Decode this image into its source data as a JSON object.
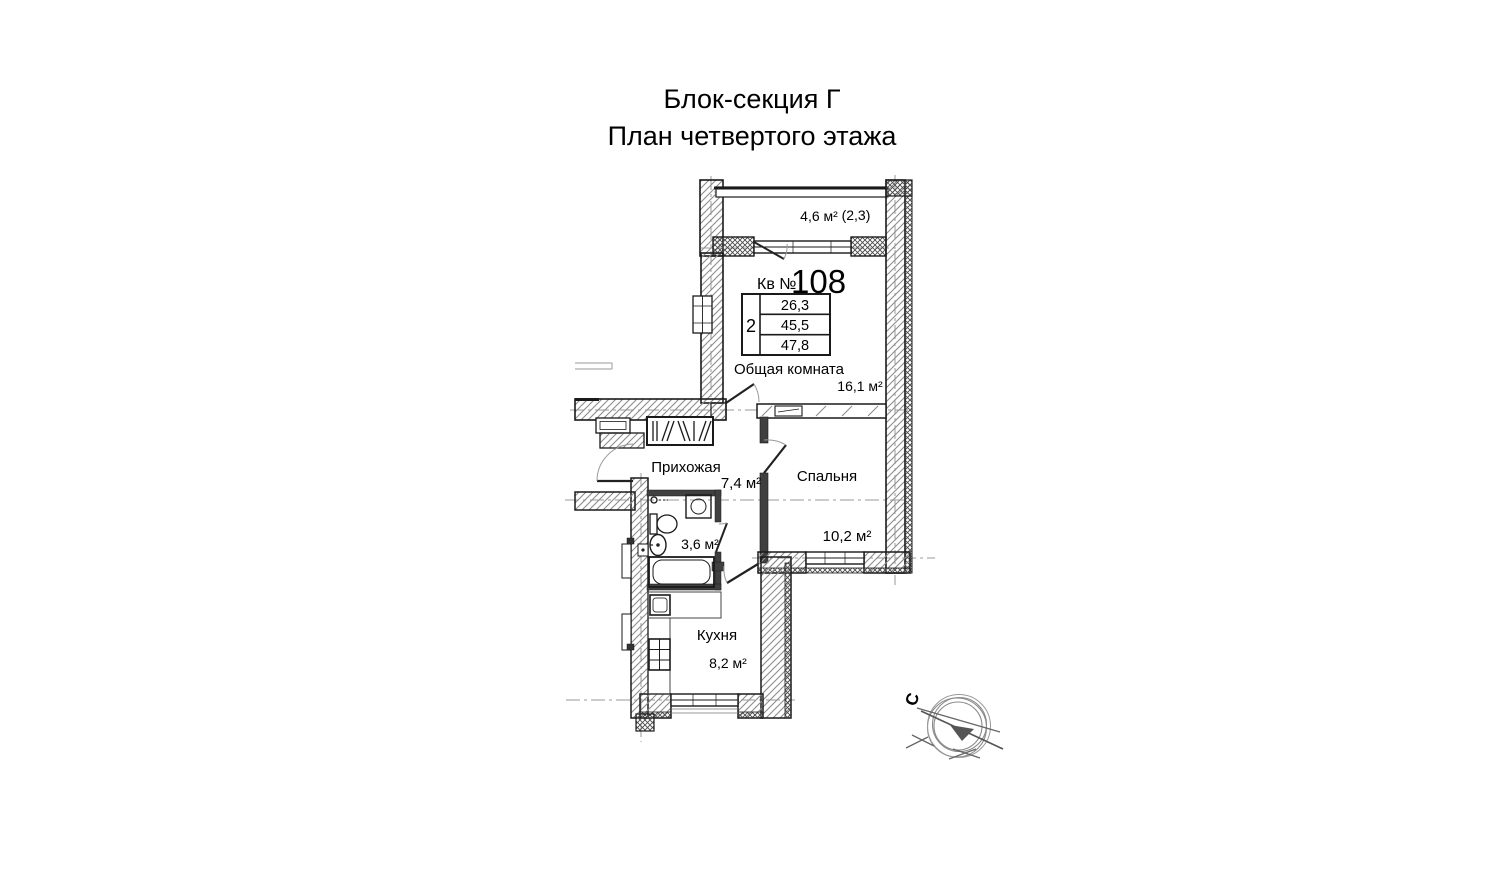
{
  "title": {
    "line1": "Блок-секция Г",
    "line2": "План четвертого этажа"
  },
  "apartment": {
    "number_label": "Кв №",
    "number": "108",
    "rooms_count": "2",
    "area_living": "26,3",
    "area_total": "45,5",
    "area_with_balcony": "47,8"
  },
  "rooms": {
    "living": {
      "name": "Общая комната",
      "area": "16,1 м²"
    },
    "bedroom": {
      "name": "Спальня",
      "area": "10,2 м²"
    },
    "hallway": {
      "name": "Прихожая",
      "area": "7,4 м²"
    },
    "kitchen": {
      "name": "Кухня",
      "area": "8,2 м²"
    },
    "bathroom": {
      "area": "3,6 м²"
    },
    "balcony": {
      "area": "4,6 м²",
      "coefficient": "(2,3)"
    }
  },
  "compass": {
    "north": "С"
  },
  "colors": {
    "line": "#1a1a1a",
    "hatch": "#8c8c8c",
    "axis": "#9a9a9a"
  }
}
